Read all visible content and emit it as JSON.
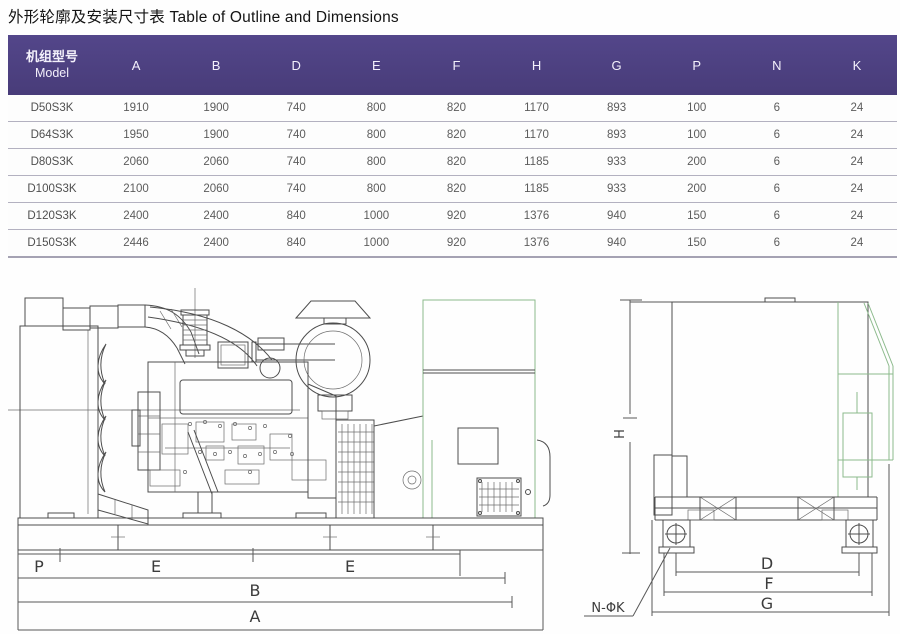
{
  "title": "外形轮廓及安装尺寸表 Table of Outline and Dimensions",
  "table": {
    "header": {
      "model_zh": "机组型号",
      "model_en": "Model",
      "columns": [
        "A",
        "B",
        "D",
        "E",
        "F",
        "H",
        "G",
        "P",
        "N",
        "K"
      ]
    },
    "rows": [
      {
        "model": "D50S3K",
        "values": [
          1910,
          1900,
          740,
          800,
          820,
          1170,
          893,
          100,
          6,
          24
        ]
      },
      {
        "model": "D64S3K",
        "values": [
          1950,
          1900,
          740,
          800,
          820,
          1170,
          893,
          100,
          6,
          24
        ]
      },
      {
        "model": "D80S3K",
        "values": [
          2060,
          2060,
          740,
          800,
          820,
          1185,
          933,
          200,
          6,
          24
        ]
      },
      {
        "model": "D100S3K",
        "values": [
          2100,
          2060,
          740,
          800,
          820,
          1185,
          933,
          200,
          6,
          24
        ]
      },
      {
        "model": "D120S3K",
        "values": [
          2400,
          2400,
          840,
          1000,
          920,
          1376,
          940,
          150,
          6,
          24
        ]
      },
      {
        "model": "D150S3K",
        "values": [
          2446,
          2400,
          840,
          1000,
          920,
          1376,
          940,
          150,
          6,
          24
        ]
      }
    ]
  },
  "drawing": {
    "side": {
      "p": "P",
      "e_left": "E",
      "e_right": "E",
      "b": "B",
      "a": "A"
    },
    "end": {
      "h": "H",
      "d": "D",
      "f": "F",
      "g": "G",
      "holes": "N-ΦK"
    }
  },
  "colors": {
    "header_bg": "#4c3f85",
    "drawing_green": "#8cba8c",
    "line": "#4d4d4d"
  }
}
